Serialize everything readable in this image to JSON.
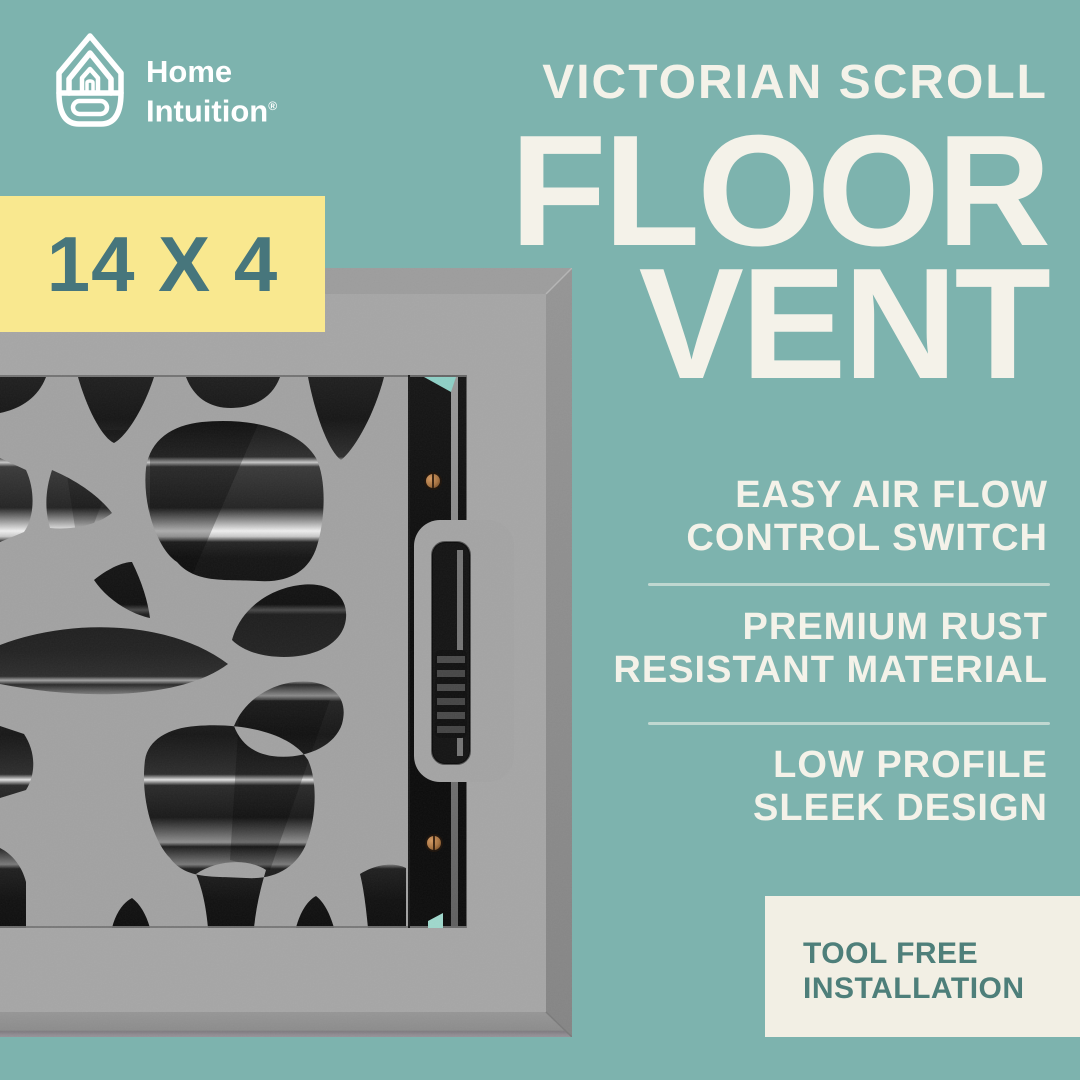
{
  "brand": {
    "line1": "Home",
    "line2": "Intuition",
    "trademark": "®"
  },
  "headline": {
    "kicker": "VICTORIAN SCROLL",
    "line1": "FLOOR",
    "line2": "VENT"
  },
  "size_badge": {
    "label": "14 X 4"
  },
  "features": [
    {
      "line1": "EASY AIR FLOW",
      "line2": "CONTROL SWITCH"
    },
    {
      "line1": "PREMIUM RUST",
      "line2": "RESISTANT MATERIAL"
    },
    {
      "line1": "LOW PROFILE",
      "line2": "SLEEK DESIGN"
    }
  ],
  "install_badge": {
    "line1": "TOOL FREE",
    "line2": "INSTALLATION"
  },
  "colors": {
    "background": "#7DB3AE",
    "headline_text": "#F4F2E9",
    "size_badge_bg": "#F9E88F",
    "size_badge_text": "#47767C",
    "install_badge_bg": "#F2EFE4",
    "install_badge_text": "#4E7F7A",
    "divider": "rgba(247,245,238,0.55)",
    "vent_metal_gray": "#A2A2A2"
  }
}
